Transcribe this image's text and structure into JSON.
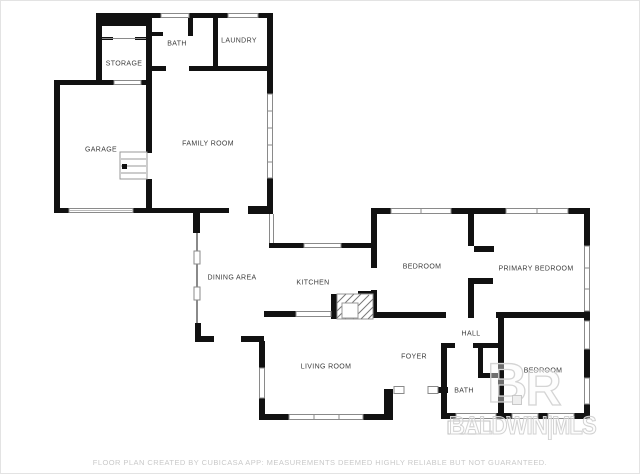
{
  "rooms": {
    "storage": "STORAGE",
    "bath_upper": "BATH",
    "laundry": "LAUNDRY",
    "garage": "GARAGE",
    "family_room": "FAMILY ROOM",
    "dining_area": "DINING AREA",
    "kitchen": "KITCHEN",
    "bedroom_top": "BEDROOM",
    "primary_bedroom": "PRIMARY BEDROOM",
    "hall": "HALL",
    "foyer": "FOYER",
    "living_room": "LIVING ROOM",
    "bath_lower": "BATH",
    "bedroom_right": "BEDROOM"
  },
  "watermark": {
    "logo_b": "B",
    "logo_r": "R",
    "brand": "BALDWIN|MLS"
  },
  "footer": {
    "disclaimer": "FLOOR PLAN CREATED BY CUBICASA APP: MEASUREMENTS DEEMED HIGHLY RELIABLE BUT NOT GUARANTEED."
  },
  "colors": {
    "wall": "#111111",
    "window_frame": "#8a8a8a",
    "label_text": "#3c3c3c",
    "watermark_gray": "#d2d2d2",
    "disclaimer_gray": "#c9c9c9",
    "background": "#ffffff"
  }
}
